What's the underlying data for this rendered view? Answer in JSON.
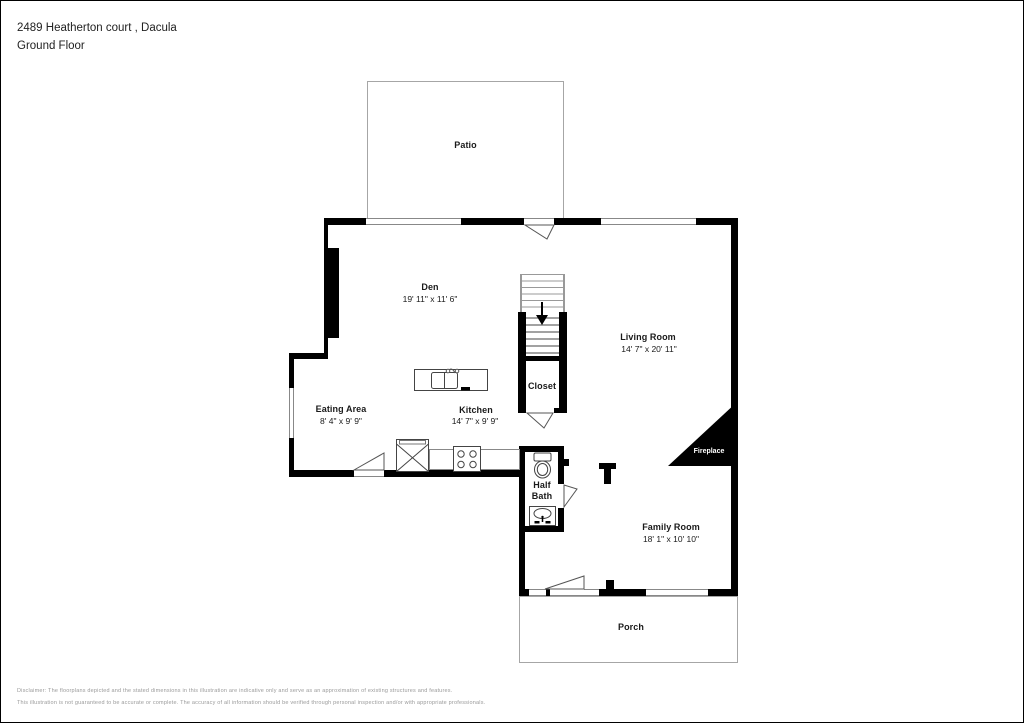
{
  "header": {
    "address": "2489 Heatherton court , Dacula",
    "floor": "Ground Floor"
  },
  "rooms": {
    "patio": {
      "name": "Patio"
    },
    "den": {
      "name": "Den",
      "dims": "19' 11\" x 11' 6\""
    },
    "living_room": {
      "name": "Living Room",
      "dims": "14' 7\" x 20' 11\""
    },
    "eating_area": {
      "name": "Eating Area",
      "dims": "8' 4\" x 9' 9\""
    },
    "kitchen": {
      "name": "Kitchen",
      "dims": "14' 7\" x 9' 9\""
    },
    "closet": {
      "name": "Closet"
    },
    "half_bath": {
      "line1": "Half",
      "line2": "Bath"
    },
    "family_room": {
      "name": "Family Room",
      "dims": "18' 1\" x 10' 10\""
    },
    "porch": {
      "name": "Porch"
    },
    "fireplace": {
      "name": "Fireplace"
    }
  },
  "icons": {
    "stairs_direction": "down-arrow"
  },
  "colors": {
    "wall": "#000000",
    "window_frame": "#888888",
    "outline_gray": "#a6a6a6",
    "fireplace_fill": "#000000",
    "fireplace_text": "#ffffff",
    "disclaimer_text": "#9a9a9a"
  },
  "disclaimer": {
    "line1": "Disclaimer: The floorplans depicted and the stated dimensions in this illustration are indicative only and serve as an approximation of existing structures and features.",
    "line2": "This illustration is not guaranteed to be accurate or complete. The accuracy of all information should be verified through personal inspection and/or with appropriate professionals."
  }
}
